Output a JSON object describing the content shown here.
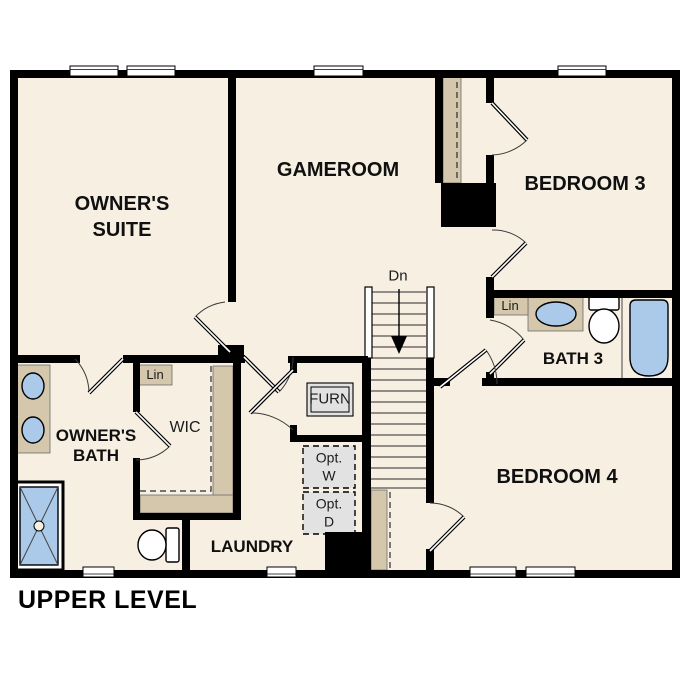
{
  "title": "UPPER LEVEL",
  "rooms": {
    "owners_suite": {
      "line1": "OWNER'S",
      "line2": "SUITE"
    },
    "gameroom": "GAMEROOM",
    "bedroom3": "BEDROOM 3",
    "bath3": "BATH 3",
    "bedroom4": "BEDROOM 4",
    "owners_bath": {
      "line1": "OWNER'S",
      "line2": "BATH"
    },
    "wic": "WIC",
    "laundry": "LAUNDRY"
  },
  "features": {
    "furnace": "FURN",
    "linen_wic": "Lin",
    "linen_bath3": "Lin",
    "opt_washer": {
      "line1": "Opt.",
      "line2": "W"
    },
    "opt_dryer": {
      "line1": "Opt.",
      "line2": "D"
    },
    "stairs_down": "Dn"
  },
  "colors": {
    "floor": "#f7efe2",
    "shelf": "#d5c7ab",
    "fixture_blue": "#abc9e8",
    "appliance_gray": "#e2e2e2",
    "wall": "#000000",
    "background": "#ffffff"
  }
}
